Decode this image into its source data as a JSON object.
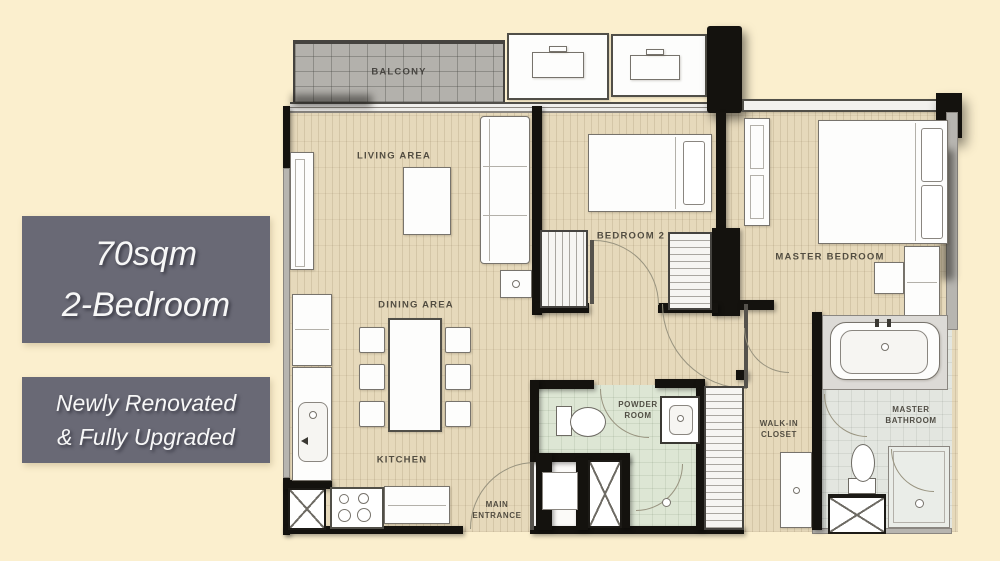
{
  "page": {
    "background_color": "#FBEFCE"
  },
  "badges": {
    "background_color": "#696975",
    "text_color": "#F7F7F7",
    "size": {
      "line1": "70sqm",
      "line2": "2-Bedroom"
    },
    "promo": {
      "line1": "Newly Renovated",
      "line2": "& Fully Upgraded"
    }
  },
  "floorplan": {
    "colors": {
      "wall": "#14120E",
      "wood_floor": "#E6D9BB",
      "tile_floor": "#E3E6E0",
      "tile_green": "#DDE6D4",
      "balcony_deck": "#B3B1AC",
      "furniture_fill": "#FDFDFC",
      "furniture_line": "#77736C"
    },
    "labels": {
      "balcony": "BALCONY",
      "living_area": "LIVING AREA",
      "dining_area": "DINING AREA",
      "kitchen": "KITCHEN",
      "main_entrance": "MAIN\nENTRANCE",
      "bedroom2": "BEDROOM 2",
      "master_bedroom": "MASTER BEDROOM",
      "powder_room": "POWDER\nROOM",
      "walk_in_closet": "WALK-IN\nCLOSET",
      "master_bathroom": "MASTER\nBATHROOM"
    }
  }
}
